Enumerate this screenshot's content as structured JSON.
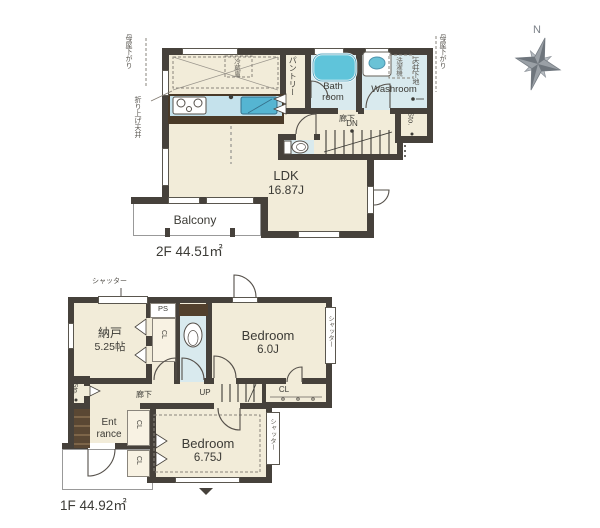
{
  "shared": {
    "cl": "CL",
    "sto": "Sto.",
    "hallway": "廊下",
    "shutter": "シャッター"
  },
  "compass": {
    "north": "N"
  },
  "floor2": {
    "area_label": "2F 44.51㎡",
    "ldk_name": "LDK",
    "ldk_size": "16.87J",
    "balcony": "Balcony",
    "bath_line1": "Bath",
    "bath_line2": "room",
    "washroom": "Washroom",
    "pantry": "パントリー",
    "dn": "DN",
    "fridge": "冷蔵庫",
    "washer": "洗濯機",
    "tenjo_shitaji": "天井下地",
    "moyasagari_left": "母屋下がり",
    "moyasagari_right": "母屋下がり",
    "oriage_tenjo": "折り上げ天井"
  },
  "floor1": {
    "area_label": "1F 44.92㎡",
    "nando_name": "納戸",
    "nando_size": "5.25帖",
    "bedroom1_name": "Bedroom",
    "bedroom1_size": "6.0J",
    "bedroom2_name": "Bedroom",
    "bedroom2_size": "6.75J",
    "entrance_line1": "Ent",
    "entrance_line2": "rance",
    "up": "UP",
    "ps": "PS"
  }
}
